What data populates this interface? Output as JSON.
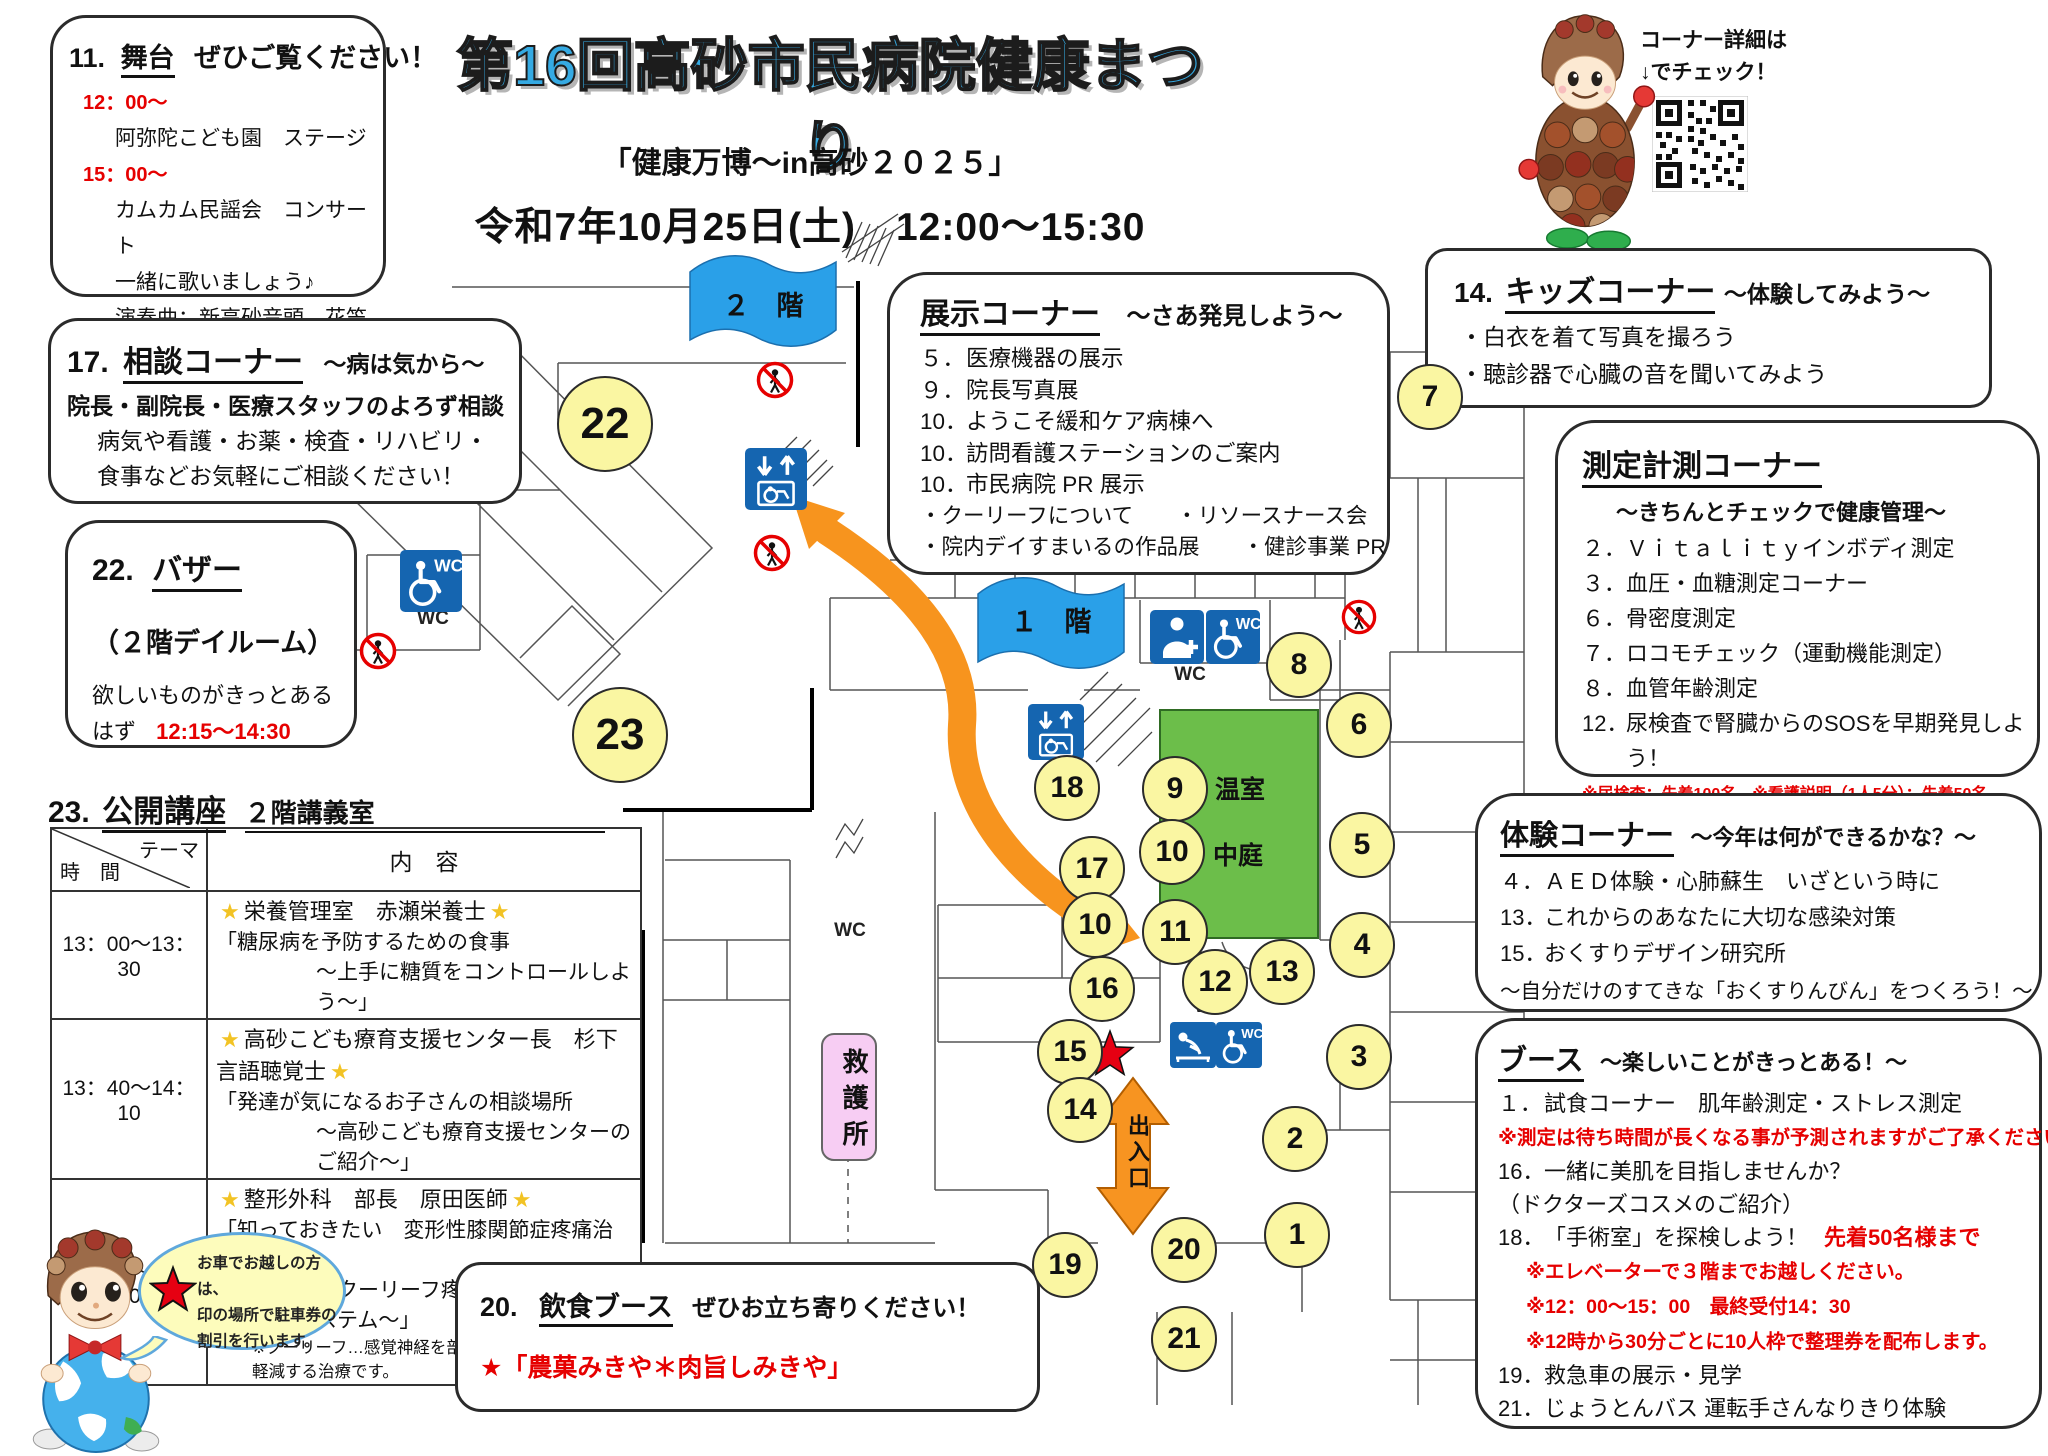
{
  "header": {
    "title": "第16回高砂市民病院健康まつり",
    "subtitle": "「健康万博～in高砂２０２５」",
    "datetime": "令和7年10月25日(土)　12:00～15:30",
    "qr_note_line1": "コーナー詳細は",
    "qr_note_line2": "↓でチェック！"
  },
  "stage": {
    "no": "11.",
    "title": "舞台",
    "tail": "ぜひご覧ください！",
    "lines": [
      {
        "text": "12：00～",
        "red": true,
        "indent": 1
      },
      {
        "text": "阿弥陀こども園　ステージ",
        "indent": 2
      },
      {
        "text": "15：00～",
        "red": true,
        "indent": 1
      },
      {
        "text": "カムカム民謡会　コンサート",
        "indent": 2
      },
      {
        "text": "一緒に歌いましょう♪",
        "indent": 2
      },
      {
        "text": "演奏曲：新高砂音頭、花笠音頭　他",
        "indent": 2
      }
    ]
  },
  "consult": {
    "no": "17.",
    "title": "相談コーナー",
    "tail": "～病は気から～",
    "lines": [
      {
        "text": "院長・副院長・医療スタッフのよろず相談",
        "bold": true
      },
      {
        "text": "病気や看護・お薬・検査・リハビリ・",
        "indent": 1
      },
      {
        "text": "食事などお気軽にご相談ください！",
        "indent": 1
      }
    ]
  },
  "bazaar": {
    "no": "22.",
    "title": "バザー",
    "line1": "（２階デイルーム）",
    "line2": "欲しいものがきっとある",
    "line3_plain": "はず",
    "line3_red": "12:15～14:30"
  },
  "lecture": {
    "no": "23.",
    "title": "公開講座",
    "room": "２階講義室",
    "col_theme": "テーマ",
    "col_time": "時　間",
    "col_content": "内　容",
    "rows": [
      {
        "time": "13：00～13：30",
        "speaker": "栄養管理室　赤瀬栄養士",
        "line1": "「糖尿病を予防するための食事",
        "line2": "～上手に糖質をコントロールしよう～」"
      },
      {
        "time": "13：40～14：10",
        "speaker": "高砂こども療育支援センター長　杉下言語聴覚士",
        "line1": "「発達が気になるお子さんの相談場所",
        "line2": "～高砂こども療育支援センターのご紹介～」"
      },
      {
        "time": "14：20～14：50",
        "speaker": "整形外科　部長　原田医師",
        "line1": "「知っておきたい　変形性膝関節症疼痛治療",
        "line2": "～クーリーフ疼痛管理用高周波システム～」",
        "note": "※クーリーフ…感覚神経を部分焼灼し、膝の痛みを軽減する治療です。"
      }
    ]
  },
  "exhibit": {
    "title": "展示コーナー",
    "tail": "～さあ発見しよう～",
    "items": [
      {
        "no": "５．",
        "text": "医療機器の展示"
      },
      {
        "no": "９．",
        "text": "院長写真展"
      },
      {
        "no": "10．",
        "text": "ようこそ緩和ケア病棟へ"
      },
      {
        "no": "10．",
        "text": "訪問看護ステーションのご案内"
      },
      {
        "no": "10．",
        "text": "市民病院 PR 展示"
      }
    ],
    "bullets": [
      "・クーリーフについて　　・リソースナース会",
      "・院内デイすまいるの作品展　　・健診事業 PR"
    ]
  },
  "kids": {
    "no": "14.",
    "title": "キッズコーナー",
    "tail": "～体験してみよう～",
    "bullets": [
      "・白衣を着て写真を撮ろう",
      "・聴診器で心臓の音を聞いてみよう"
    ]
  },
  "measure": {
    "title": "測定計測コーナー",
    "subtitle": "～きちんとチェックで健康管理～",
    "items": [
      {
        "no": "２．",
        "text": "Ｖｉｔａｌｉｔｙインボディ測定"
      },
      {
        "no": "３．",
        "text": "血圧・血糖測定コーナー"
      },
      {
        "no": "６．",
        "text": "骨密度測定"
      },
      {
        "no": "７．",
        "text": "ロコモチェック（運動機能測定）"
      },
      {
        "no": "８．",
        "text": "血管年齢測定"
      },
      {
        "no": "12．",
        "text": "尿検査で腎臓からのSOSを早期発見しよう！"
      }
    ],
    "note": "※尿検査：先着100名　※看護説明（1人5分）：先着50名"
  },
  "taiken": {
    "title": "体験コーナー",
    "tail": "～今年は何ができるかな？～",
    "items": [
      {
        "no": "４．",
        "text": "ＡＥＤ体験・心肺蘇生　いざという時に"
      },
      {
        "no": "13．",
        "text": "これからのあなたに大切な感染対策"
      },
      {
        "no": "15．",
        "text": "おくすりデザイン研究所"
      }
    ],
    "tail_line": "～自分だけのすてきな「おくすりんびん」をつくろう！～"
  },
  "booth": {
    "title": "ブース",
    "tail": "～楽しいことがきっとある！～",
    "lines": [
      {
        "no": "１．",
        "text": "試食コーナー　肌年齢測定・ストレス測定"
      },
      {
        "red": "※測定は待ち時間が長くなる事が予測されますがご了承ください。"
      },
      {
        "no": "16．",
        "text": "一緒に美肌を目指しませんか？"
      },
      {
        "text": "（ドクターズコスメのご紹介）"
      },
      {
        "no": "18．",
        "text": "「手術室」を探検しよう！",
        "red_tail": "先着50名様まで"
      },
      {
        "red": "※エレベーターで３階までお越しください。",
        "indent": 1
      },
      {
        "red": "※12：00～15：00　最終受付14：30",
        "indent": 1
      },
      {
        "red": "※12時から30分ごとに10人枠で整理券を配布します。",
        "indent": 1
      },
      {
        "no": "19．",
        "text": "救急車の展示・見学"
      },
      {
        "no": "21．",
        "text": "じょうとんバス 運転手さんなりきり体験"
      }
    ]
  },
  "food": {
    "no": "20.",
    "title": "飲食ブース",
    "tail": "ぜひお立ち寄りください！",
    "red_line": "★「農菓みきや＊肉旨しみきや」"
  },
  "bubble": {
    "lines": [
      "お車でお越しの方は、",
      "印の場所で駐車券の",
      "割引を行います。"
    ]
  },
  "map": {
    "floor2_label": "２　階",
    "floor1_label": "１　階",
    "greenhouse": "温室",
    "courtyard": "中庭",
    "first_aid": "救護所",
    "entrance": "出入口",
    "wc": "WC",
    "colors": {
      "circle_fill": "#faf6a2",
      "green_area": "#6cbe4a",
      "arrow_orange": "#f7941e",
      "banner_blue": "#2aa0e8",
      "icon_blue": "#1565b0",
      "aid_pink": "#f7cdf3",
      "star_red": "#e60012"
    },
    "circles": [
      {
        "n": "22",
        "x": 603,
        "y": 422,
        "d": 92
      },
      {
        "n": "23",
        "x": 618,
        "y": 733,
        "d": 92
      },
      {
        "n": "7",
        "x": 1428,
        "y": 395,
        "d": 62
      },
      {
        "n": "8",
        "x": 1297,
        "y": 663,
        "d": 62
      },
      {
        "n": "6",
        "x": 1357,
        "y": 723,
        "d": 62
      },
      {
        "n": "18",
        "x": 1065,
        "y": 786,
        "d": 62
      },
      {
        "n": "9",
        "x": 1173,
        "y": 787,
        "d": 62
      },
      {
        "n": "5",
        "x": 1360,
        "y": 843,
        "d": 62
      },
      {
        "n": "10",
        "x": 1170,
        "y": 850,
        "d": 62
      },
      {
        "n": "17",
        "x": 1090,
        "y": 867,
        "d": 62
      },
      {
        "n": "10",
        "x": 1093,
        "y": 923,
        "d": 62
      },
      {
        "n": "11",
        "x": 1173,
        "y": 930,
        "d": 62
      },
      {
        "n": "4",
        "x": 1360,
        "y": 943,
        "d": 62
      },
      {
        "n": "13",
        "x": 1280,
        "y": 970,
        "d": 62
      },
      {
        "n": "12",
        "x": 1213,
        "y": 980,
        "d": 62
      },
      {
        "n": "16",
        "x": 1100,
        "y": 987,
        "d": 62
      },
      {
        "n": "15",
        "x": 1068,
        "y": 1050,
        "d": 62
      },
      {
        "n": "3",
        "x": 1357,
        "y": 1055,
        "d": 62
      },
      {
        "n": "14",
        "x": 1078,
        "y": 1108,
        "d": 62
      },
      {
        "n": "2",
        "x": 1293,
        "y": 1137,
        "d": 62
      },
      {
        "n": "1",
        "x": 1295,
        "y": 1233,
        "d": 62
      },
      {
        "n": "20",
        "x": 1182,
        "y": 1248,
        "d": 62
      },
      {
        "n": "19",
        "x": 1063,
        "y": 1263,
        "d": 62
      },
      {
        "n": "21",
        "x": 1182,
        "y": 1337,
        "d": 62
      }
    ]
  }
}
